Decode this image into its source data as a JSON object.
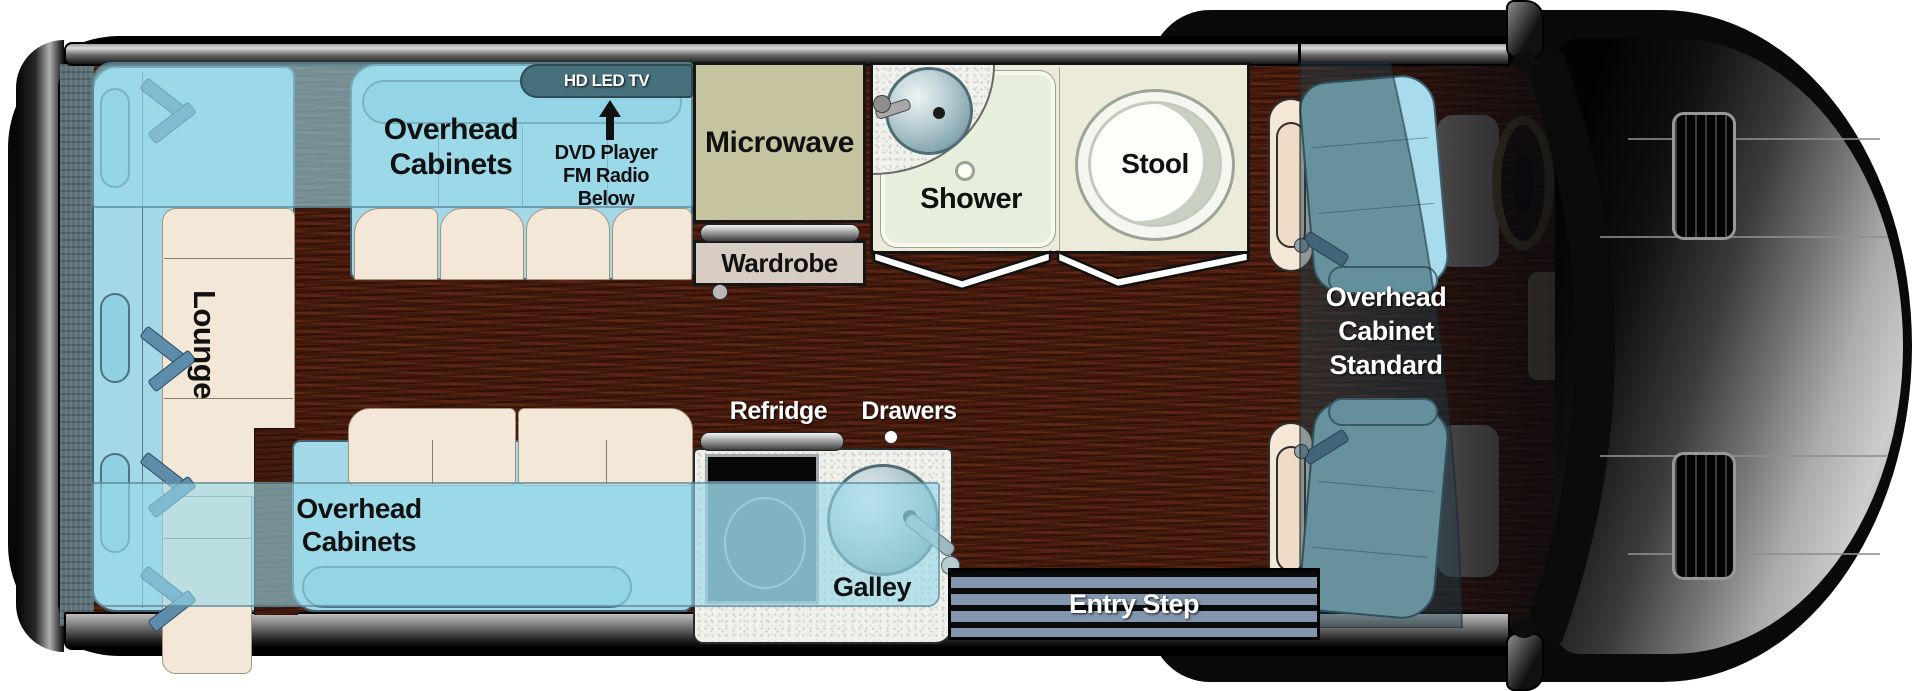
{
  "title": "Class B motorhome floor plan (top view)",
  "floorplan": {
    "rear_lounge": {
      "label": "Lounge"
    },
    "top_sofa": {
      "cabinet_line1": "Overhead",
      "cabinet_line2": "Cabinets",
      "tv_label": "HD LED TV",
      "av_line1": "DVD Player",
      "av_line2": "FM Radio",
      "av_line3": "Below"
    },
    "kitchen_wall": {
      "microwave": "Microwave",
      "wardrobe": "Wardrobe"
    },
    "bathroom": {
      "shower": "Shower",
      "stool": "Stool"
    },
    "cab_overhead": {
      "line1": "Overhead",
      "line2": "Cabinet",
      "line3": "Standard"
    },
    "bottom_sofa": {
      "cabinet_line1": "Overhead",
      "cabinet_line2": "Cabinets"
    },
    "galley": {
      "refrigerator": "Refridge",
      "drawers": "Drawers",
      "label": "Galley"
    },
    "entry": {
      "label": "Entry Step"
    }
  },
  "colors": {
    "seat_blue": "#a3d8e6",
    "backrest_blue": "#8fd0e2",
    "cushion_cream": "#f3e8d8",
    "floor_brown": "#42190d",
    "overhead_band": "rgba(150,216,232,0.62)",
    "microwave_olive": "#c6c4a0",
    "wardrobe_tan": "#d8cdc2",
    "bathroom_cream": "#ecead9",
    "shower_green": "#e6efdc",
    "entry_stripe_blue": "#8296ad",
    "tv_tab_teal": "#47707d",
    "van_body_black": "#0a0a0a",
    "seatbelt_blue": "#5e8cab"
  }
}
